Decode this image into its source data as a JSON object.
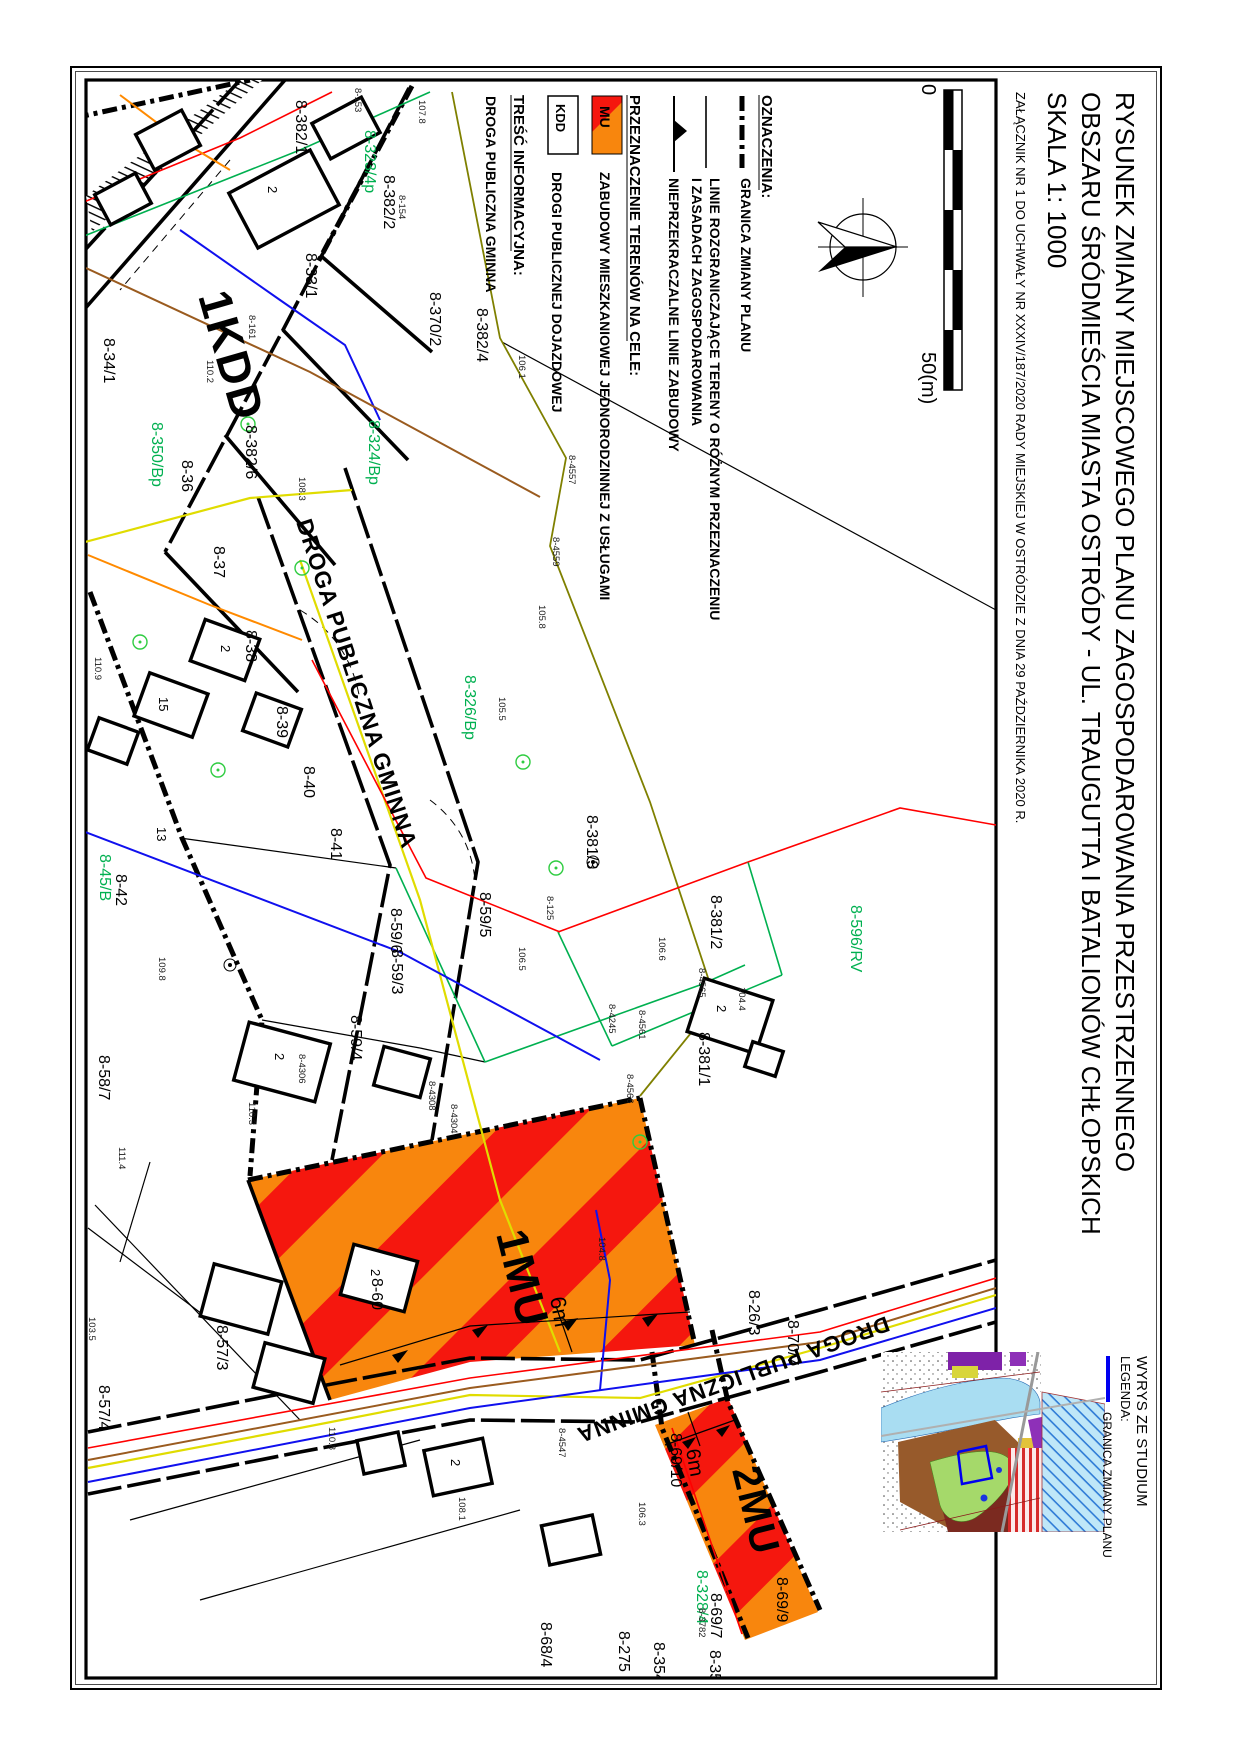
{
  "title_block": {
    "line1": "RYSUNEK ZMIANY MIEJSCOWEGO PLANU ZAGOSPODAROWANIA PRZESTRZENNEGO",
    "line2": "OBSZARU ŚRÓDMIEŚCIA MIASTA OSTRÓDY - UL. TRAUGUTTA I BATALIONÓW CHŁOPSKICH",
    "line3": "SKALA  1: 1000",
    "attachment": "ZAŁĄCZNIK NR 1 DO UCHWAŁY NR XXXIV/187/2020  RADY  MIEJSKIEJ W OSTRÓDZIE Z DNIA 29 PAŹDZIERNIKA 2020 R."
  },
  "legend": {
    "heading_oznaczenia": "OZNACZENIA:",
    "granica_label": "GRANICA ZMIANY PLANU",
    "linie_rozgr_line1": "LINIE ROZGRANICZAJĄCE TERENY O RÓŻNYM PRZEZNACZENIU",
    "linie_rozgr_line2": "I ZASADACH ZAGOSPODAROWANIA",
    "nieprzekraczalne_label": "NIEPRZEKRACZALNE LINIE ZABUDOWY",
    "heading_przeznaczenie": "PRZEZNACZENIE TERENÓW NA CELE:",
    "mu_code": "MU",
    "mu_label": "ZABUDOWY MIESZKANIOWEJ JEDNORODZINNEJ Z USŁUGAMI",
    "kdd_code": "KDD",
    "kdd_label": "DROGI PUBLICZNEJ DOJAZDOWEJ",
    "heading_tresc": "TREŚĆ INFORMACYJNA:",
    "droga_label": "DROGA PUBLICZNA GMINNA"
  },
  "scalebar": {
    "start": "0",
    "end": "50(m)"
  },
  "inset": {
    "title": "WYRYS ZE STUDIUM",
    "legend_heading": "LEGENDA:",
    "legend_item": "GRANICA ZMIANY PLANU"
  },
  "map": {
    "zone_labels": [
      {
        "t": "1KDD",
        "x": 198,
        "y": 296,
        "r": 74,
        "s": 46
      },
      {
        "t": "1MU",
        "x": 496,
        "y": 1234,
        "r": 76,
        "s": 44
      },
      {
        "t": "2MU",
        "x": 732,
        "y": 1470,
        "r": 76,
        "s": 40
      }
    ],
    "road_labels": [
      {
        "t": "DROGA PUBLICZNA GMINNA",
        "x": 296,
        "y": 522,
        "r": 72,
        "s": 23
      },
      {
        "t": "DROGA PUBLICZNA GMINNA",
        "x": 886,
        "y": 1316,
        "r": 160,
        "s": 22
      }
    ],
    "dim_labels": [
      {
        "t": "6m",
        "x": 550,
        "y": 1298,
        "r": 80,
        "s": 22
      },
      {
        "t": "6m",
        "x": 686,
        "y": 1450,
        "r": 80,
        "s": 20
      }
    ],
    "parcel_labels": [
      {
        "t": "8-382/1",
        "x": 296,
        "y": 100
      },
      {
        "t": "8-33/1",
        "x": 306,
        "y": 253
      },
      {
        "t": "8-382/2",
        "x": 384,
        "y": 175
      },
      {
        "t": "8-370/2",
        "x": 430,
        "y": 292
      },
      {
        "t": "8-382/4",
        "x": 477,
        "y": 308
      },
      {
        "t": "8-382/6",
        "x": 246,
        "y": 425
      },
      {
        "t": "8-34/1",
        "x": 104,
        "y": 338
      },
      {
        "t": "8-36",
        "x": 182,
        "y": 460
      },
      {
        "t": "8-37",
        "x": 214,
        "y": 546
      },
      {
        "t": "8-38",
        "x": 246,
        "y": 630
      },
      {
        "t": "8-39",
        "x": 277,
        "y": 706
      },
      {
        "t": "8-40",
        "x": 304,
        "y": 766
      },
      {
        "t": "8-41",
        "x": 331,
        "y": 828
      },
      {
        "t": "8-42",
        "x": 116,
        "y": 874
      },
      {
        "t": "8-45/B",
        "x": 100,
        "y": 854,
        "c": "green"
      },
      {
        "t": "8-350/Bp",
        "x": 152,
        "y": 422,
        "c": "green"
      },
      {
        "t": "8-323/4p",
        "x": 365,
        "y": 130,
        "c": "green"
      },
      {
        "t": "8-324/Bp",
        "x": 369,
        "y": 420,
        "c": "green"
      },
      {
        "t": "8-326/Bp",
        "x": 465,
        "y": 675,
        "c": "green"
      },
      {
        "t": "8-596/RV",
        "x": 851,
        "y": 905,
        "c": "green"
      },
      {
        "t": "8-328/4",
        "x": 697,
        "y": 1570,
        "c": "green"
      },
      {
        "t": "8-381/3",
        "x": 587,
        "y": 815
      },
      {
        "t": "8-381/2",
        "x": 711,
        "y": 895
      },
      {
        "t": "8-381/1",
        "x": 699,
        "y": 1032
      },
      {
        "t": "8-59/5",
        "x": 480,
        "y": 892
      },
      {
        "t": "8-59/6",
        "x": 391,
        "y": 908
      },
      {
        "t": "8-59/3",
        "x": 392,
        "y": 949
      },
      {
        "t": "8-59/4",
        "x": 351,
        "y": 1015
      },
      {
        "t": "8-58/7",
        "x": 99,
        "y": 1055
      },
      {
        "t": "8-26/3",
        "x": 749,
        "y": 1290
      },
      {
        "t": "8-57/3",
        "x": 217,
        "y": 1325
      },
      {
        "t": "8-57/4",
        "x": 99,
        "y": 1385
      },
      {
        "t": "8-60",
        "x": 372,
        "y": 1278
      },
      {
        "t": "8-70/7",
        "x": 788,
        "y": 1320
      },
      {
        "t": "8-69/10",
        "x": 671,
        "y": 1433
      },
      {
        "t": "8-69/9",
        "x": 777,
        "y": 1577
      },
      {
        "t": "8-69/7",
        "x": 711,
        "y": 1593
      },
      {
        "t": "8-68/4",
        "x": 541,
        "y": 1622
      },
      {
        "t": "8-275",
        "x": 619,
        "y": 1631
      },
      {
        "t": "8-354/",
        "x": 654,
        "y": 1642
      },
      {
        "t": "8-35",
        "x": 710,
        "y": 1650
      }
    ],
    "point_labels": [
      {
        "t": "8-4557",
        "x": 569,
        "y": 455
      },
      {
        "t": "8-4559",
        "x": 553,
        "y": 537
      },
      {
        "t": "8-4561",
        "x": 639,
        "y": 1010
      },
      {
        "t": "8-4566",
        "x": 627,
        "y": 1074
      },
      {
        "t": "8-4565",
        "x": 699,
        "y": 968
      },
      {
        "t": "8-4245",
        "x": 609,
        "y": 1004
      },
      {
        "t": "8-4306",
        "x": 299,
        "y": 1054
      },
      {
        "t": "8-4308",
        "x": 429,
        "y": 1081
      },
      {
        "t": "8-4304",
        "x": 451,
        "y": 1104
      },
      {
        "t": "8-4547",
        "x": 559,
        "y": 1428
      },
      {
        "t": "8-3782",
        "x": 699,
        "y": 1608
      },
      {
        "t": "8-125",
        "x": 547,
        "y": 896
      },
      {
        "t": "8-153",
        "x": 355,
        "y": 88
      },
      {
        "t": "8-154",
        "x": 399,
        "y": 195
      },
      {
        "t": "8-161",
        "x": 249,
        "y": 315
      },
      {
        "t": "110.2",
        "x": 207,
        "y": 360
      },
      {
        "t": "108.3",
        "x": 299,
        "y": 477
      },
      {
        "t": "106.5",
        "x": 519,
        "y": 947
      },
      {
        "t": "104.4",
        "x": 739,
        "y": 987
      },
      {
        "t": "106.6",
        "x": 659,
        "y": 937
      },
      {
        "t": "107.8",
        "x": 419,
        "y": 100
      },
      {
        "t": "105.5",
        "x": 499,
        "y": 697
      },
      {
        "t": "110.3",
        "x": 249,
        "y": 1102
      },
      {
        "t": "111.4",
        "x": 119,
        "y": 1147
      },
      {
        "t": "109.8",
        "x": 159,
        "y": 957
      },
      {
        "t": "106.1",
        "x": 519,
        "y": 355
      },
      {
        "t": "103.5",
        "x": 89,
        "y": 1317
      },
      {
        "t": "110.8",
        "x": 329,
        "y": 1427
      },
      {
        "t": "104.8",
        "x": 599,
        "y": 1237
      },
      {
        "t": "108.1",
        "x": 459,
        "y": 1497
      },
      {
        "t": "106.3",
        "x": 639,
        "y": 1502
      },
      {
        "t": "105.8",
        "x": 539,
        "y": 605
      },
      {
        "t": "110.9",
        "x": 95,
        "y": 657
      }
    ],
    "building_labels": [
      {
        "t": "2",
        "x": 268,
        "y": 186
      },
      {
        "t": "2",
        "x": 221,
        "y": 645
      },
      {
        "t": "15",
        "x": 159,
        "y": 697
      },
      {
        "t": "13",
        "x": 157,
        "y": 827
      },
      {
        "t": "2",
        "x": 275,
        "y": 1053
      },
      {
        "t": "2",
        "x": 371,
        "y": 1269
      },
      {
        "t": "2",
        "x": 451,
        "y": 1459
      },
      {
        "t": "2",
        "x": 717,
        "y": 1005
      }
    ]
  },
  "colors": {
    "zone_orange": "#F8860D",
    "zone_red": "#F5170E",
    "cadastral_green": "#00B050",
    "utility_red": "#FF0000",
    "utility_blue": "#1010EE",
    "utility_yellow": "#E0DC00",
    "utility_brown": "#9A5B1F",
    "utility_orange": "#FF8A00",
    "olive": "#7F8000",
    "inset_granica_blue": "#0000F0"
  }
}
